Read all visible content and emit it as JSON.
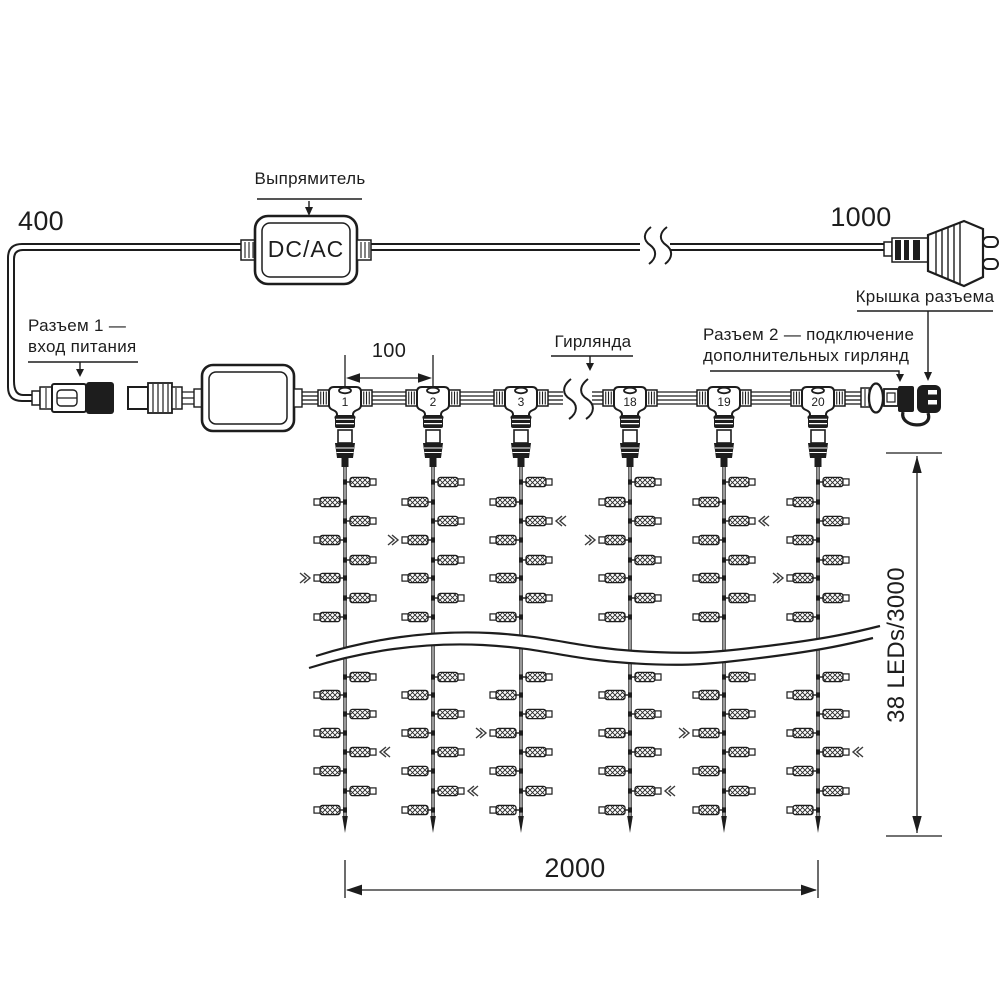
{
  "labels": {
    "dim_left_cable": "400",
    "dim_right_cable": "1000",
    "dim_connector_spacing": "100",
    "dim_curtain_width": "2000",
    "dim_curtain_height": "38 LEDs/3000",
    "rectifier": "Выпрямитель",
    "rectifier_box": "DC/AC",
    "connector1_line1": "Разъем 1 —",
    "connector1_line2": "вход питания",
    "garland": "Гирлянда",
    "connector2_line1": "Разъем 2 — подключение",
    "connector2_line2": "дополнительных гирлянд",
    "connector_cap": "Крышка разъема"
  },
  "curtain": {
    "string_connector_numbers": [
      "1",
      "2",
      "3",
      "18",
      "19",
      "20"
    ],
    "strings_count": 6,
    "leds_visible_per_string": 16
  },
  "colors": {
    "line": "#1d1d1d",
    "background": "#ffffff"
  }
}
